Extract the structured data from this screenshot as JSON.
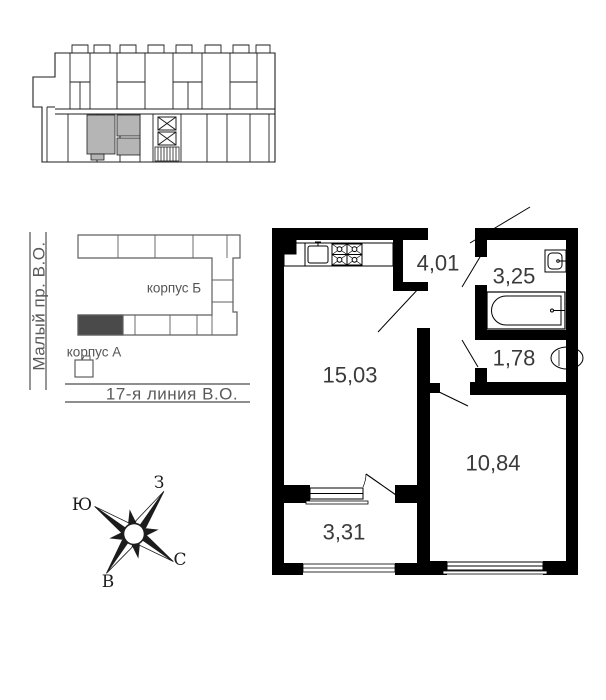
{
  "apartment": {
    "wall_color": "#000000",
    "label_color": "#3a3a3a",
    "rooms": [
      {
        "name": "hallway",
        "area": "4,01"
      },
      {
        "name": "bathroom",
        "area": "3,25"
      },
      {
        "name": "toilet",
        "area": "1,78"
      },
      {
        "name": "living-kitchen",
        "area": "15,03"
      },
      {
        "name": "bedroom",
        "area": "10,84"
      },
      {
        "name": "balcony",
        "area": "3,31"
      }
    ]
  },
  "floor_overview": {
    "highlight_color": "#b5b5b5"
  },
  "site_plan": {
    "street_left": "Малый пр. В.О.",
    "street_bottom": "17-я линия В.О.",
    "building_b_label": "корпус Б",
    "building_a_label": "корпус А",
    "outline_color": "#5f5f5f",
    "text_color": "#5a5a5a",
    "highlight_color": "#4a4a4a"
  },
  "compass": {
    "north": "С",
    "south": "Ю",
    "west": "З",
    "east": "В"
  }
}
